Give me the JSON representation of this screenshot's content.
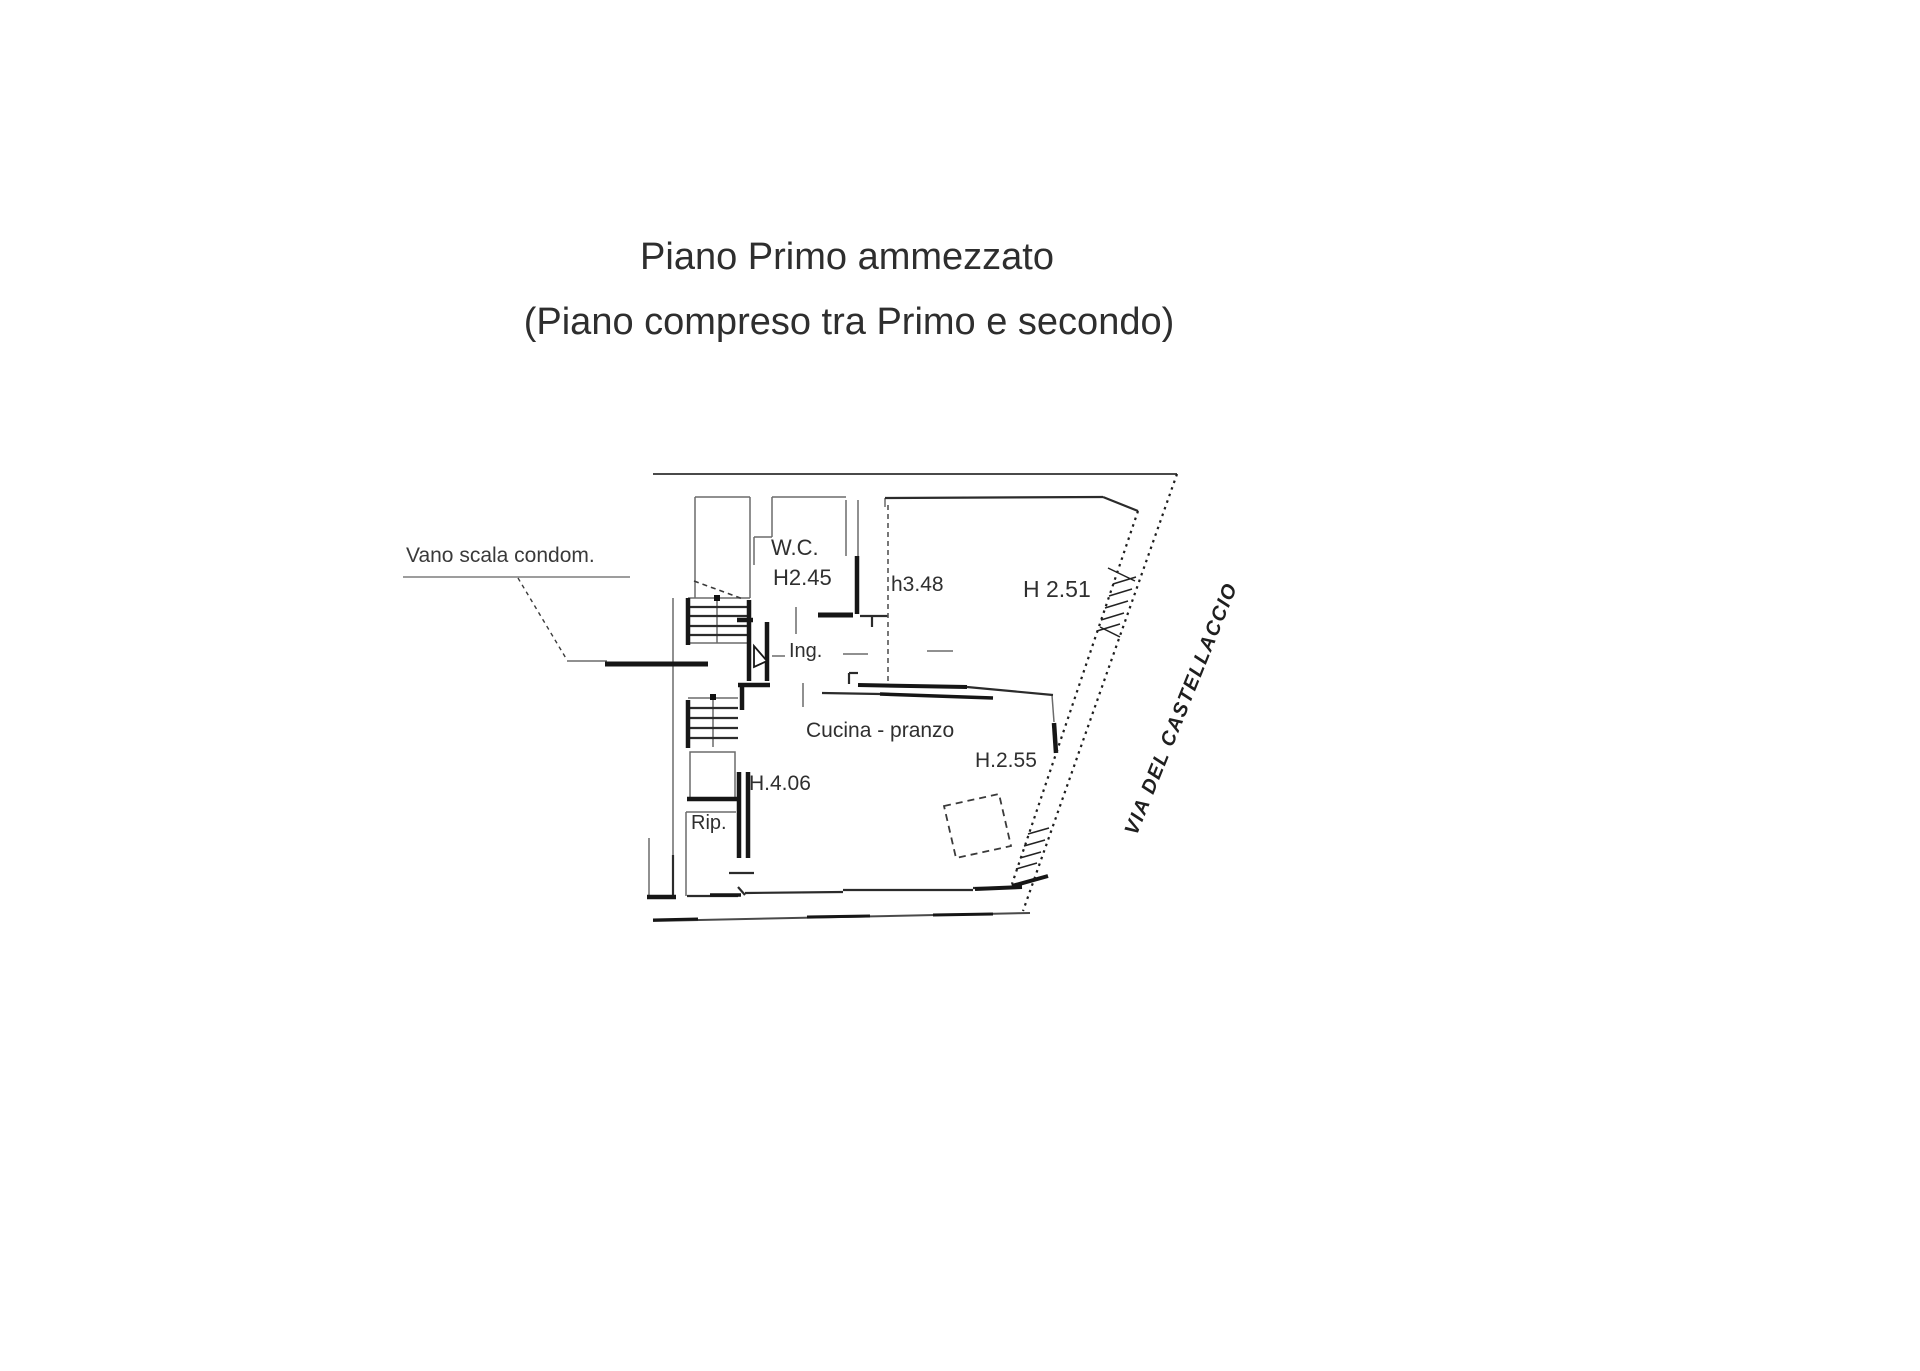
{
  "document": {
    "title": "Piano Primo ammezzato",
    "subtitle": "(Piano compreso tra Primo e secondo)"
  },
  "floorplan": {
    "leader_note": "Vano scala condom.",
    "rooms": {
      "wc": {
        "label": "W.C.",
        "height": "H2.45"
      },
      "mid_zone": {
        "height": "h3.48"
      },
      "right_room": {
        "height": "H 2.51"
      },
      "entrance": {
        "label": "Ing."
      },
      "kitchen": {
        "label": "Cucina - pranzo",
        "height": "H.2.55"
      },
      "stairwell_zone": {
        "height": "H.4.06"
      },
      "storage": {
        "label": "Rip."
      }
    },
    "street": {
      "name": "VIA DEL CASTELLACCIO"
    }
  },
  "colors": {
    "background": "#ffffff",
    "ink": "#2e2e2e",
    "wall": "#161616",
    "thin_line": "#6b6b6b"
  }
}
